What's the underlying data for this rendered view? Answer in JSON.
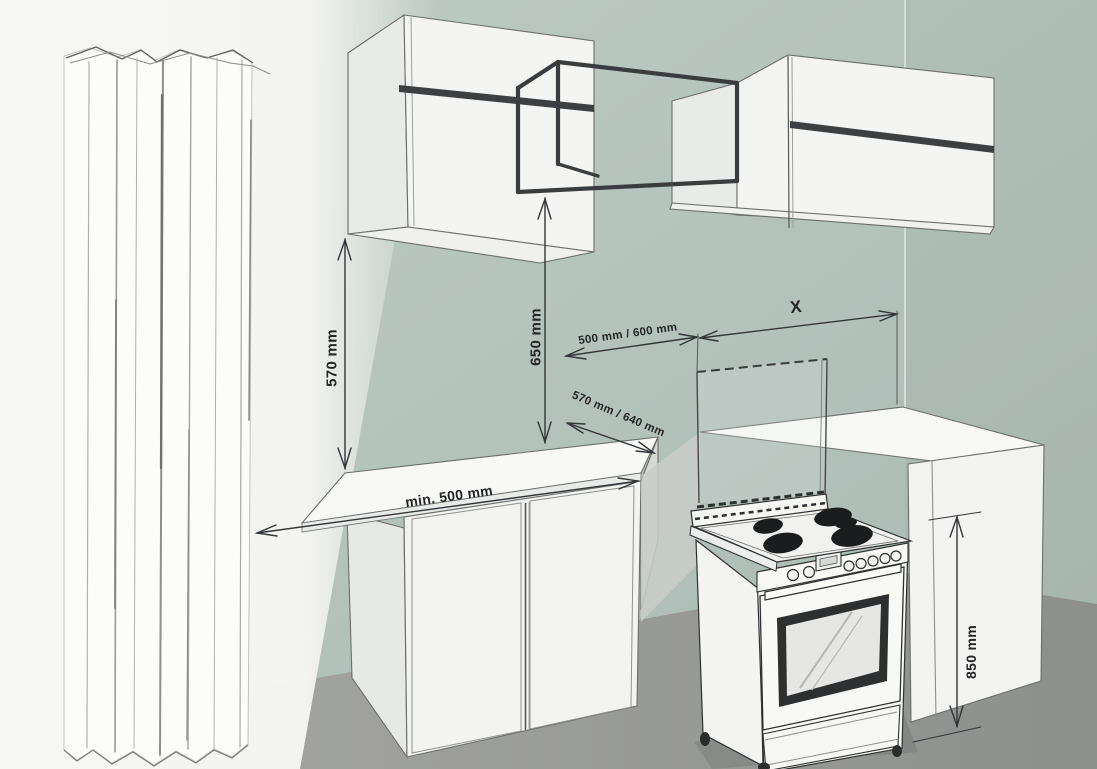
{
  "diagram": {
    "title": "kitchen cooker installation clearance drawing",
    "dimension_labels": [
      {
        "id": "wall-cabinet-to-worktop",
        "text": "570 mm",
        "orientation": "vertical"
      },
      {
        "id": "hood-space-to-worktop",
        "text": "650 mm",
        "orientation": "vertical"
      },
      {
        "id": "hood-space-width",
        "text": "500 mm / 600 mm",
        "orientation": "diagonal"
      },
      {
        "id": "cooker-to-corner",
        "text": "X",
        "orientation": "horizontal"
      },
      {
        "id": "worktop-depth",
        "text": "570 mm / 640 mm",
        "orientation": "diagonal"
      },
      {
        "id": "worktop-to-curtain",
        "text": "min. 500 mm",
        "orientation": "diagonal"
      },
      {
        "id": "worktop-height",
        "text": "850 mm",
        "orientation": "vertical"
      }
    ],
    "colors": {
      "wall": "#b4c2bc",
      "floor": "#989a98",
      "cabinet_face": "#f4f5f2",
      "outline": "#33363a",
      "stripe_dark": "#3d4043",
      "text": "#232527"
    }
  }
}
